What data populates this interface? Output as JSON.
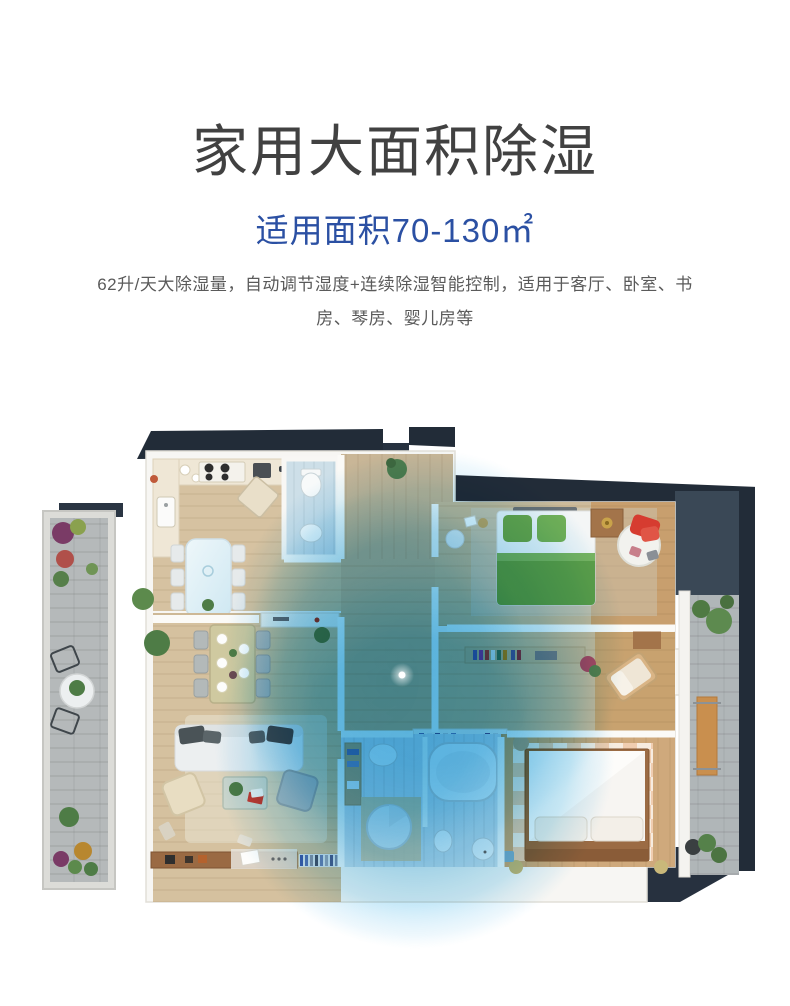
{
  "header": {
    "title": "家用大面积除湿",
    "subtitle": "适用面积70-130㎡",
    "description_line1": "62升/天大除湿量，自动调节湿度+连续除湿智能控制，适用于客厅、卧室、书",
    "description_line2": "房、琴房、婴儿房等"
  },
  "colors": {
    "title_text": "#414141",
    "subtitle_blue": "#2b50a3",
    "description_text": "#5a5a5a",
    "coverage_blue": "#35a9e1",
    "coverage_rim": "#cfeaf6",
    "dark_exterior": "#222c38",
    "dark_exterior_light": "#3a4856",
    "wall_white": "#f7f6f3",
    "wood_floor": "#d6c2a1",
    "wood_floor_warm": "#c89f6e",
    "balcony_gray": "#b5b9ba",
    "bed_green": "#5ea04a",
    "accent_red": "#d63c30"
  },
  "floorplan": {
    "name": "apartment-top-view-floor-plan",
    "device": {
      "marker": "dehumidifier-location-dot",
      "marker_color": "#ffffff"
    },
    "rooms": [
      "kitchen",
      "dining-area",
      "small-bathroom",
      "entry-hallway",
      "living-room",
      "bedroom-top-right",
      "study-room",
      "master-bedroom",
      "main-bathroom",
      "balcony-left",
      "balcony-right"
    ]
  }
}
